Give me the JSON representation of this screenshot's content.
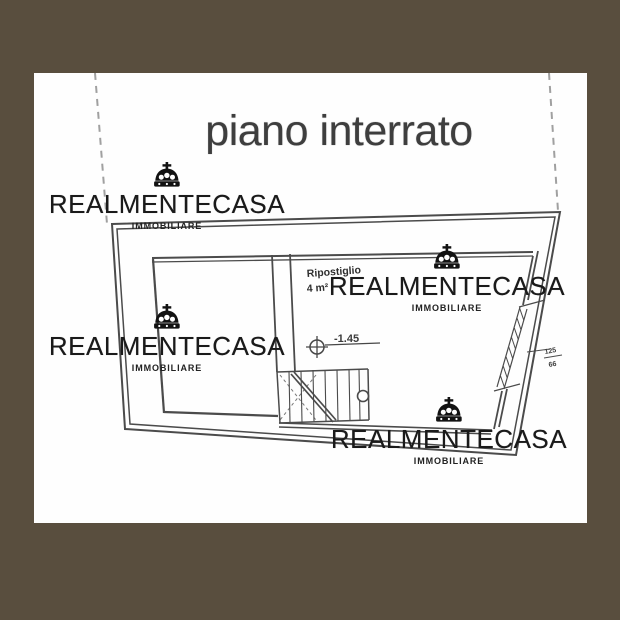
{
  "page": {
    "title": "piano interrato"
  },
  "watermark": {
    "brand": "REALMENTECASA",
    "sub": "IMMOBILIARE"
  },
  "plan": {
    "room_label": "Ripostiglio",
    "room_area": "4 m²",
    "level_label": "-1.45",
    "window_width_label": "125",
    "window_height_label": "66"
  },
  "colors": {
    "frame": "#594e3e",
    "paper": "#ffffff",
    "title": "#3e3e3e",
    "plan_line": "#4b4b4b",
    "watermark": "#1a1a1a",
    "dashed_boundary": "#a0a0a0"
  }
}
